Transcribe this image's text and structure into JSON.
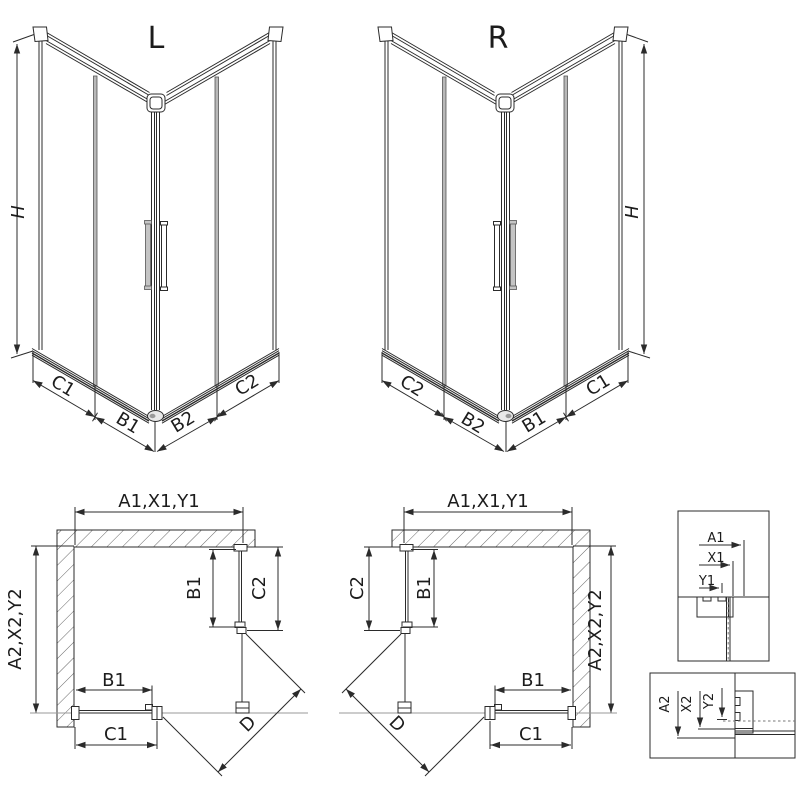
{
  "drawing": {
    "type": "shower-enclosure-installation-diagram",
    "line_color": "#2b2b2b",
    "gray_color": "#999999"
  },
  "labels": {
    "persp_left": {
      "title": "L",
      "height": "H",
      "seg_c1": "C1",
      "seg_b1": "B1",
      "seg_b2": "B2",
      "seg_c2": "C2"
    },
    "persp_right": {
      "title": "R",
      "height": "H",
      "seg_c1": "C1",
      "seg_b1": "B1",
      "seg_b2": "B2",
      "seg_c2": "C2"
    },
    "plan_left": {
      "width_top": "A1,X1,Y1",
      "depth_side": "A2,X2,Y2",
      "side_b1": "B1",
      "side_c2": "C2",
      "bottom_b1": "B1",
      "bottom_c1": "C1",
      "diagonal": "D"
    },
    "plan_right": {
      "width_top": "A1,X1,Y1",
      "depth_side": "A2,X2,Y2",
      "side_b1": "B1",
      "side_c2": "C2",
      "bottom_b1": "B1",
      "bottom_c1": "C1",
      "diagonal": "D"
    },
    "detail_width": {
      "dim_a1": "A1",
      "dim_x1": "X1",
      "dim_y1": "Y1"
    },
    "detail_depth": {
      "dim_a2": "A2",
      "dim_x2": "X2",
      "dim_y2": "Y2"
    }
  }
}
